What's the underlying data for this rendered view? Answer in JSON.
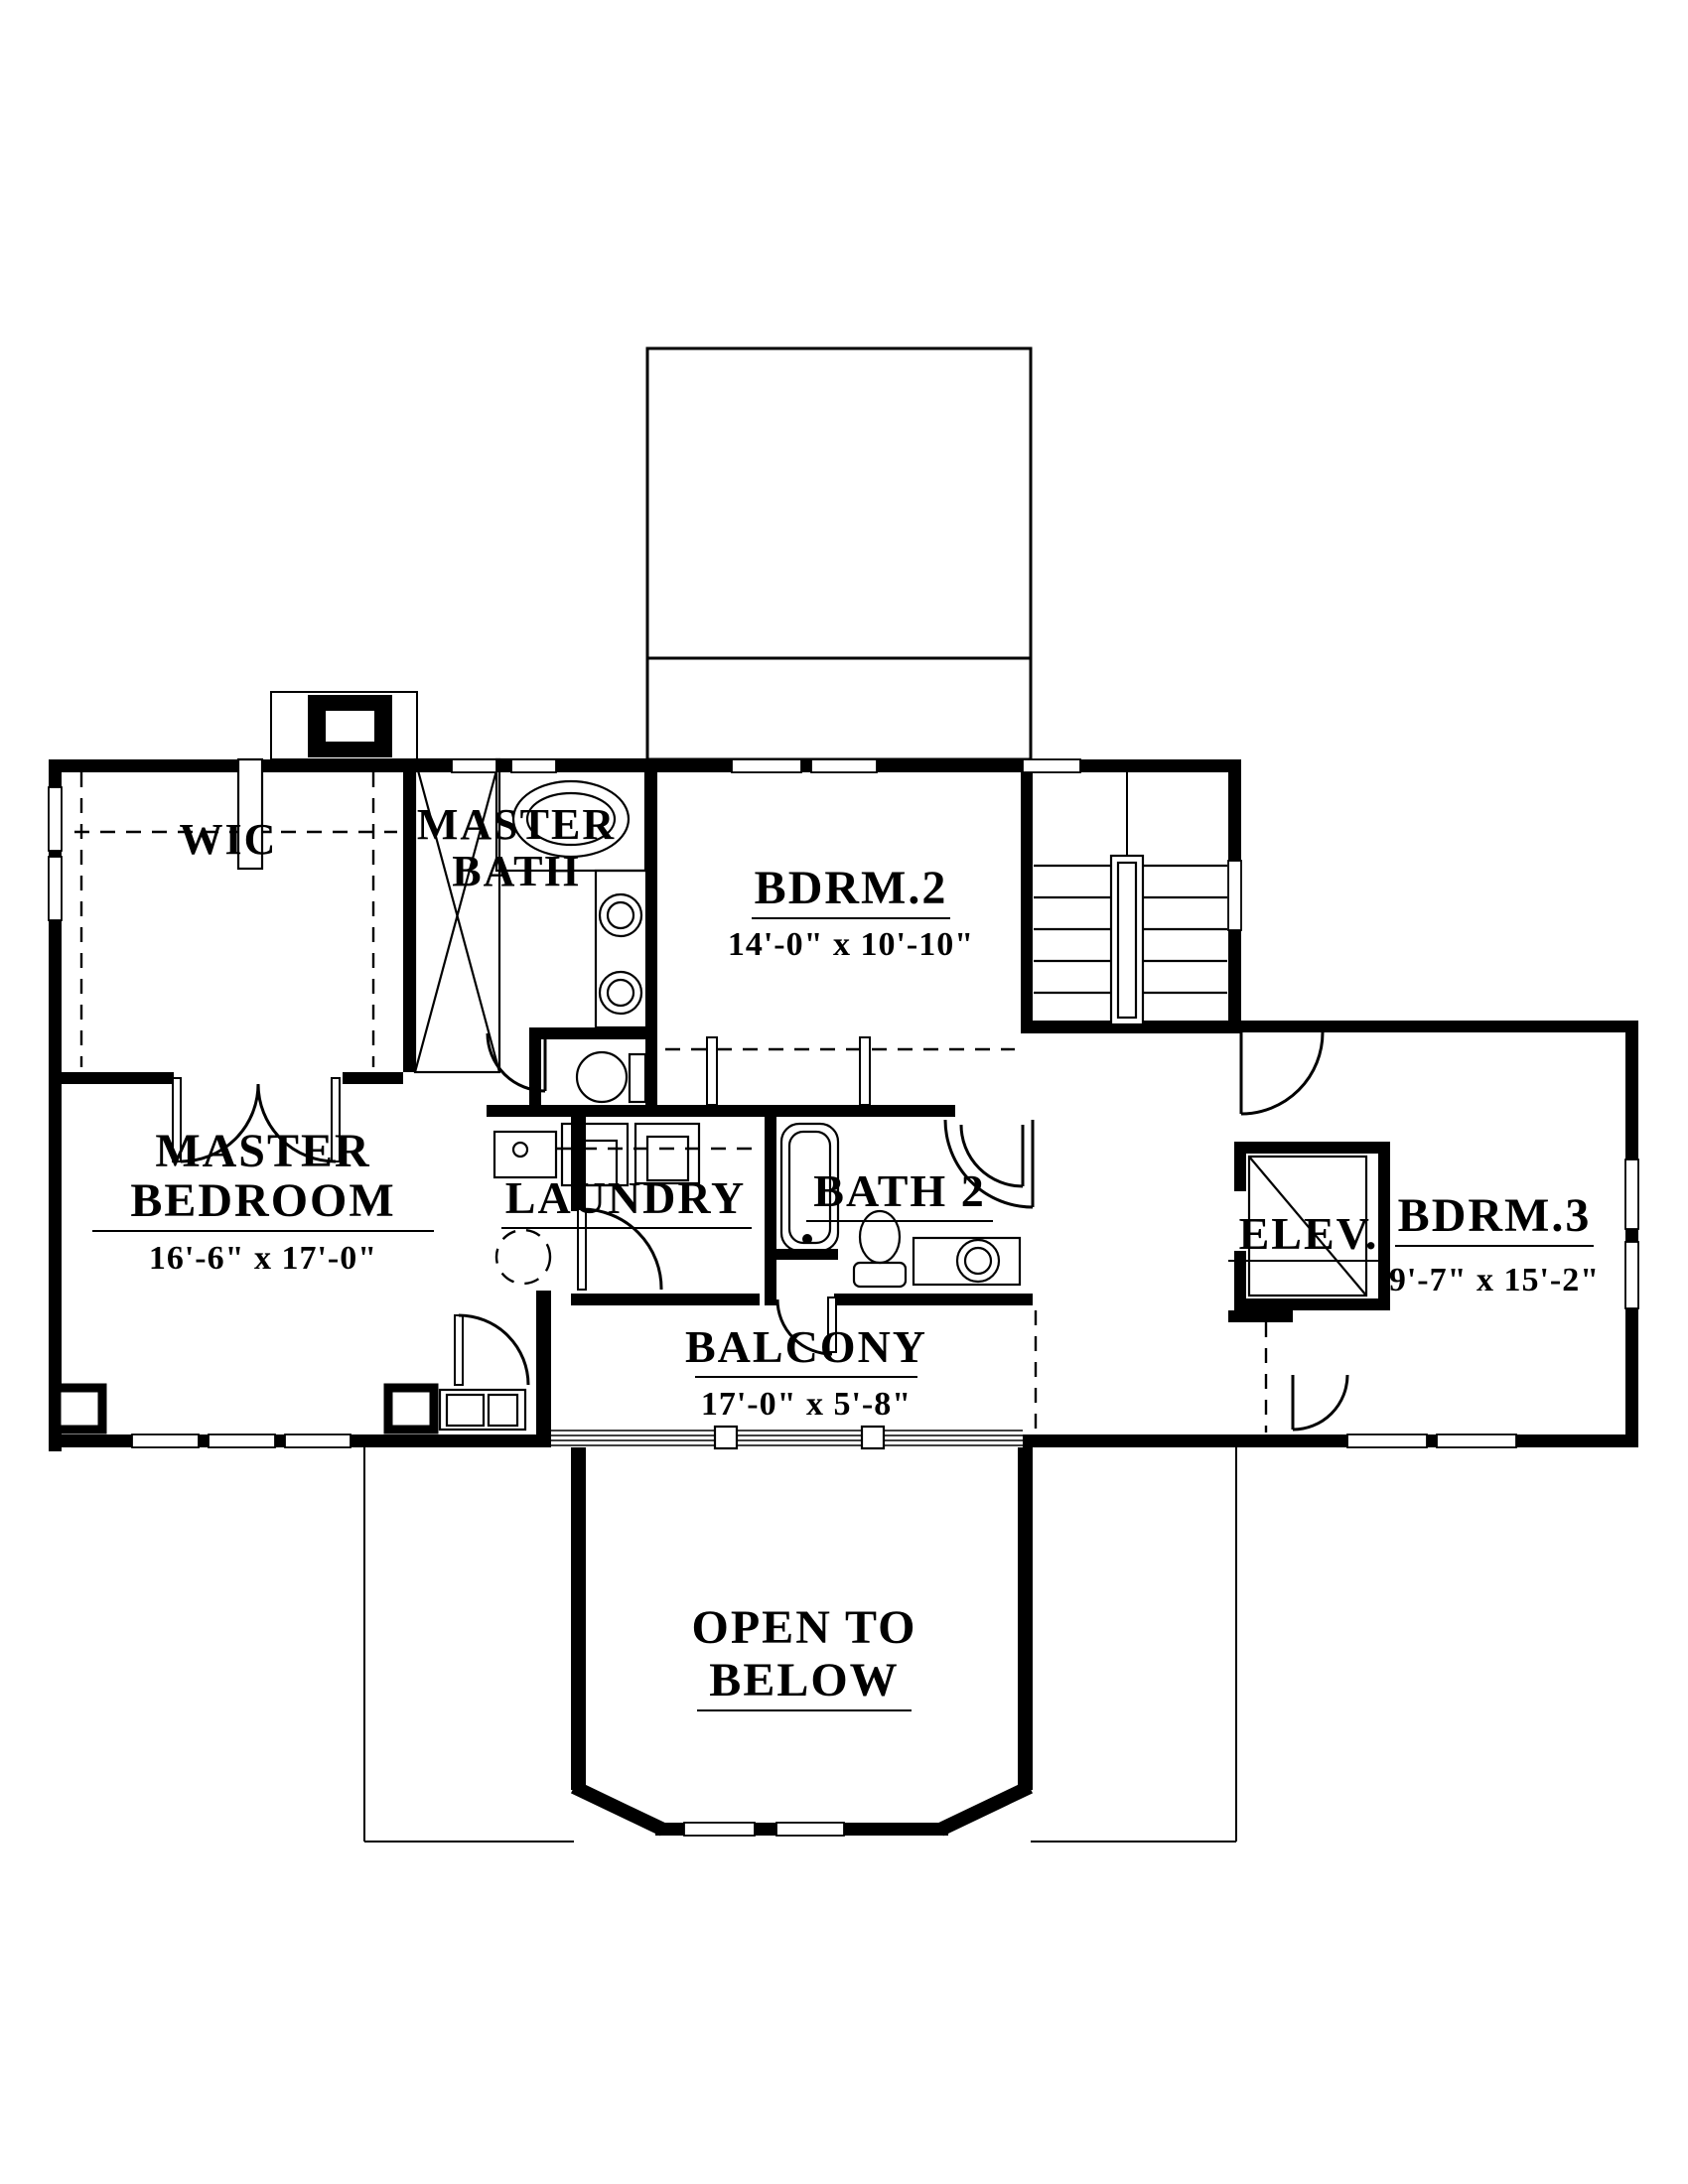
{
  "document": {
    "type": "architectural-floor-plan",
    "floor": "second-floor",
    "ink_color": "#000000",
    "paper_color": "#ffffff"
  },
  "labels": {
    "wic": "WIC",
    "master_bath_line1": "MASTER",
    "master_bath_line2": "BATH",
    "bdrm2": "BDRM.2",
    "master_bedroom_line1": "MASTER",
    "master_bedroom_line2": "BEDROOM",
    "laundry": "LAUNDRY",
    "bath2": "BATH 2",
    "elev": "ELEV.",
    "bdrm3": "BDRM.3",
    "balcony": "BALCONY",
    "open_below_line1": "OPEN TO",
    "open_below_line2": "BELOW"
  },
  "dims": {
    "bdrm2": "14'-0\" x 10'-10\"",
    "master_bedroom": "16'-6\" x 17'-0\"",
    "bdrm3": "9'-7\" x 15'-2\"",
    "balcony": "17'-0\" x 5'-8\""
  },
  "symbols": [
    "shower-icon",
    "garden-tub-icon",
    "double-vanity-sinks-icon",
    "toilet-icon",
    "bathtub-icon",
    "utility-sink-icon",
    "washer-icon",
    "dryer-icon",
    "stairs-icon",
    "elevator-shaft-icon",
    "balcony-railing-icon",
    "door-swing-icon",
    "window-icon",
    "chimney-icon",
    "bay-window-icon",
    "closet-shelving-dashed"
  ]
}
